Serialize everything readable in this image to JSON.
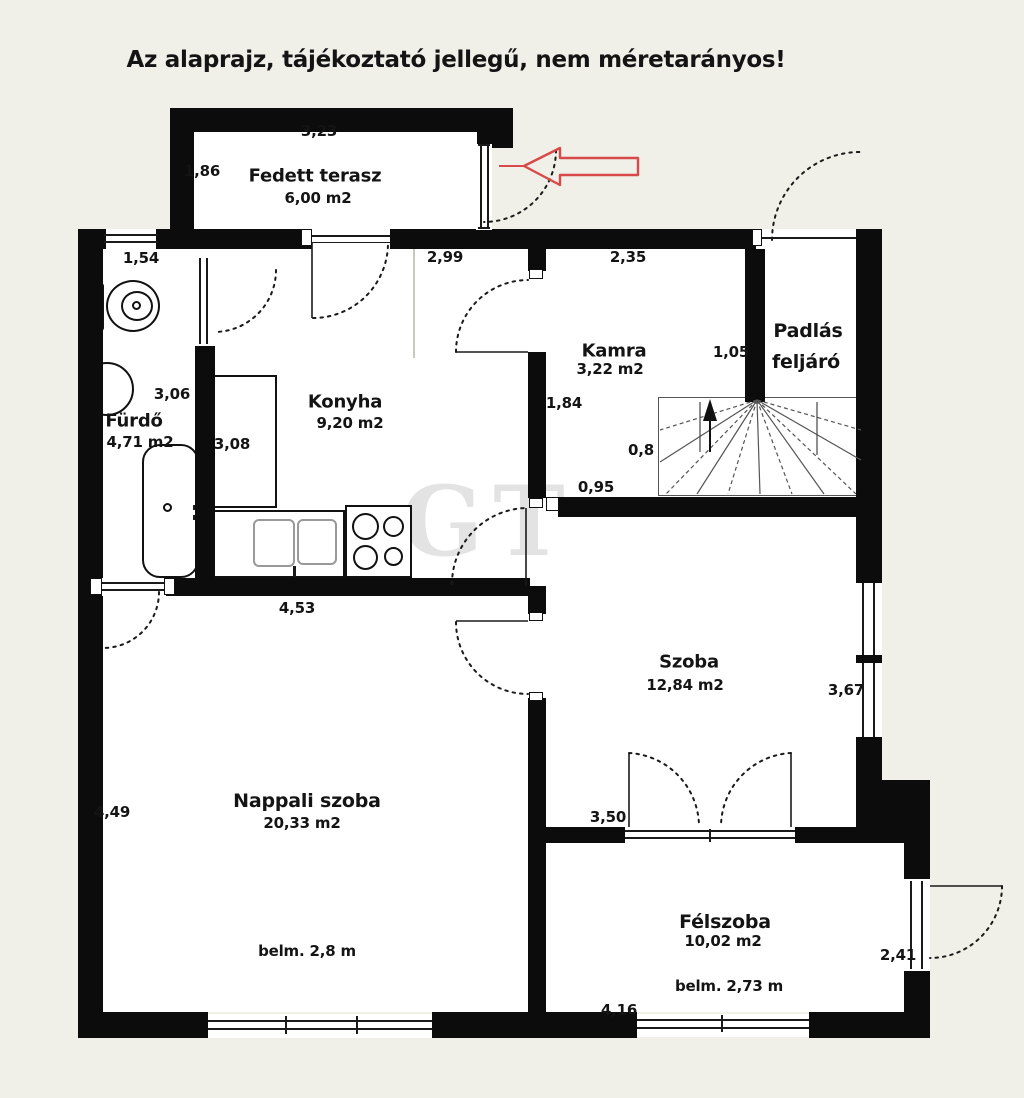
{
  "title": "Az alaprajz, tájékoztató jellegű, nem méretarányos!",
  "watermark": "GT",
  "rooms": {
    "terrace": {
      "name": "Fedett terasz",
      "area": "6,00 m2"
    },
    "bathroom": {
      "name": "Fürdő",
      "area": "4,71 m2"
    },
    "kitchen": {
      "name": "Konyha",
      "area": "9,20 m2"
    },
    "pantry": {
      "name": "Kamra",
      "area": "3,22 m2"
    },
    "attic_access": {
      "line1": "Padlás",
      "line2": "feljáró"
    },
    "room": {
      "name": "Szoba",
      "area": "12,84 m2"
    },
    "living_room": {
      "name": "Nappali szoba",
      "area": "20,33 m2",
      "ceiling": "belm. 2,8 m"
    },
    "half_room": {
      "name": "Félszoba",
      "area": "10,02 m2",
      "ceiling": "belm. 2,73 m"
    }
  },
  "dims": {
    "terrace_width": "3,23",
    "terrace_depth": "1,86",
    "bath_window": "1,54",
    "kitchen_top": "2,99",
    "pantry_top": "2,35",
    "attic_width": "1,05",
    "bath_height": "3,06",
    "kitchen_height": "3,08",
    "pantry_left": "1,84",
    "stair_width": "0,8",
    "corridor": "0,95",
    "kitchen_width": "4,53",
    "room_right": "3,67",
    "living_left": "4,49",
    "half_top": "3,50",
    "half_door": "2,41",
    "half_bottom": "4,16"
  }
}
